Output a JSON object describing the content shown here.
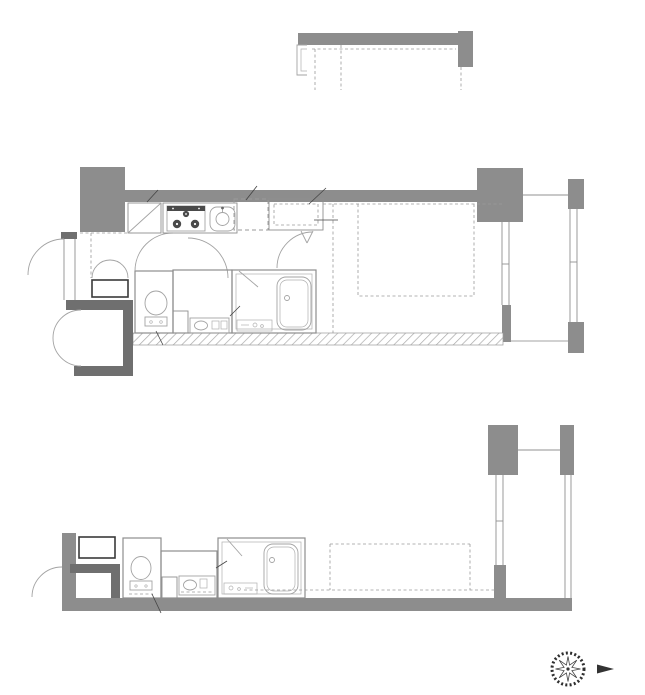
{
  "colors": {
    "wall_gray": "#8d8d8d",
    "wall_dark": "#6f6f6f",
    "line_gray": "#9a9a9a",
    "text_color": "#1c1c1c"
  },
  "plan_11f": {
    "caption": "■Btype(11階部分図)"
  },
  "plan_main": {
    "genkan": "玄関",
    "shoe_box": "靴入",
    "meter_box": "MB",
    "toilet": "トイレ",
    "washer_line1": "洗濯機",
    "washer_line2": "置場",
    "fridge_line1": "冷蔵庫",
    "fridge_line2": "置場",
    "closet": "クローゼット",
    "hallway": "廊下",
    "washroom": "洗面脱衣室",
    "pipe_space": "PS",
    "bath_line1": "バス",
    "bath_line2": "ルーム",
    "room_line1": "洋室",
    "room_line2": "(約7.7帖)",
    "balcony": "バルコニー",
    "note_cupboard_top": "吊戸棚",
    "note_cupboard_bottom": "吊戸棚",
    "note_floors_5_11": "(5〜11Fのみ)",
    "note_floors_7_11": "(7〜11Fのみ)",
    "note_floors_3_11": "(3〜11Fのみ)"
  },
  "plan_1f": {
    "caption": "■Btype(1階部分",
    "shoe_box": "靴入",
    "meter_box": "MB",
    "toilet": "トイレ",
    "washroom": "洗面脱衣室",
    "pipe_space": "PS",
    "bath_line1": "バス",
    "bath_line2": "ルーム",
    "balcony": "バルコニー",
    "note_cupboard": "吊戸棚"
  },
  "compass": {
    "north_label": "N"
  }
}
